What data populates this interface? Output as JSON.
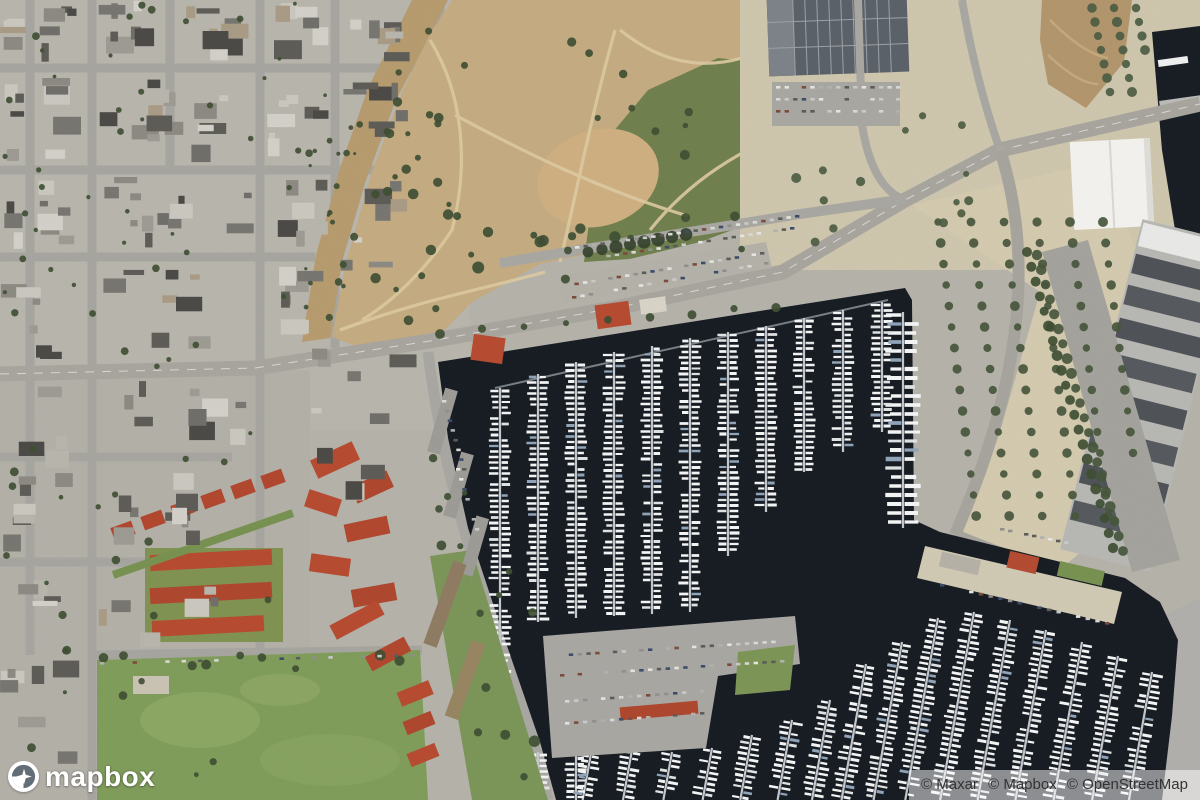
{
  "logo": {
    "label": "mapbox",
    "icon": "mapbox-logo-icon"
  },
  "attribution": {
    "items": [
      "© Maxar",
      "© Mapbox",
      "© OpenStreetMap"
    ]
  },
  "map": {
    "type": "satellite",
    "colors": {
      "water": "#151a21",
      "land_base": "#b4b1a9",
      "park_dirt": "#c3aa80",
      "park_green": "#6e7e4b",
      "field_green": "#7e9b59",
      "red_roof": "#b5492e",
      "tan_lot": "#d2c9ae",
      "boat_white": "#f3f4f4",
      "attribution_bg": "rgba(255,255,255,0.5)",
      "attribution_text": "#333333",
      "logo_text": "#ffffff"
    }
  }
}
